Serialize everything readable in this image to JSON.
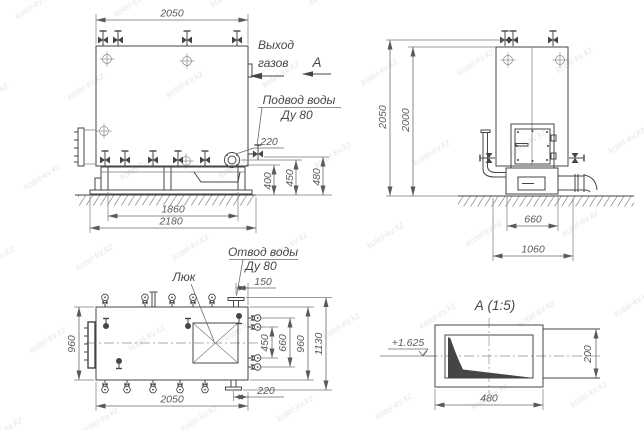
{
  "watermark": {
    "text": "kotel-kv.kz"
  },
  "colors": {
    "ink": "#454545",
    "dim_lines": "#6a6a6a",
    "watermark": "#e5e7ea",
    "background": "#ffffff"
  },
  "front_view": {
    "dim_width_top": "2050",
    "dim_flange_offset": "220",
    "dim_height_1": "400",
    "dim_height_2": "450",
    "dim_height_3": "480",
    "dim_frame_inner": "1860",
    "dim_frame_outer": "2180",
    "label_gas_outlet_line1": "Выход",
    "label_gas_outlet_line2": "газов",
    "label_view_arrow": "А",
    "label_water_inlet_line1": "Подвод воды",
    "label_water_inlet_line2": "Ду 80"
  },
  "side_view": {
    "dim_height_overall": "2050",
    "dim_height_body": "2000",
    "dim_base_width": "660",
    "dim_foundation_width": "1060"
  },
  "top_view": {
    "label_water_outlet_line1": "Отвод воды",
    "label_water_outlet_line2": "Ду 80",
    "label_hatch": "Люк",
    "dim_outlet_offset": "150",
    "dim_depth_left": "960",
    "dim_valve_span": "450",
    "dim_branch_span": "660",
    "dim_body_depth": "960",
    "dim_overall_depth": "1130",
    "dim_length": "2050",
    "dim_drain_offset": "220"
  },
  "detail_a": {
    "title": "А  (1:5)",
    "elevation_mark": "+1.625",
    "dim_width": "480",
    "dim_height": "200"
  }
}
